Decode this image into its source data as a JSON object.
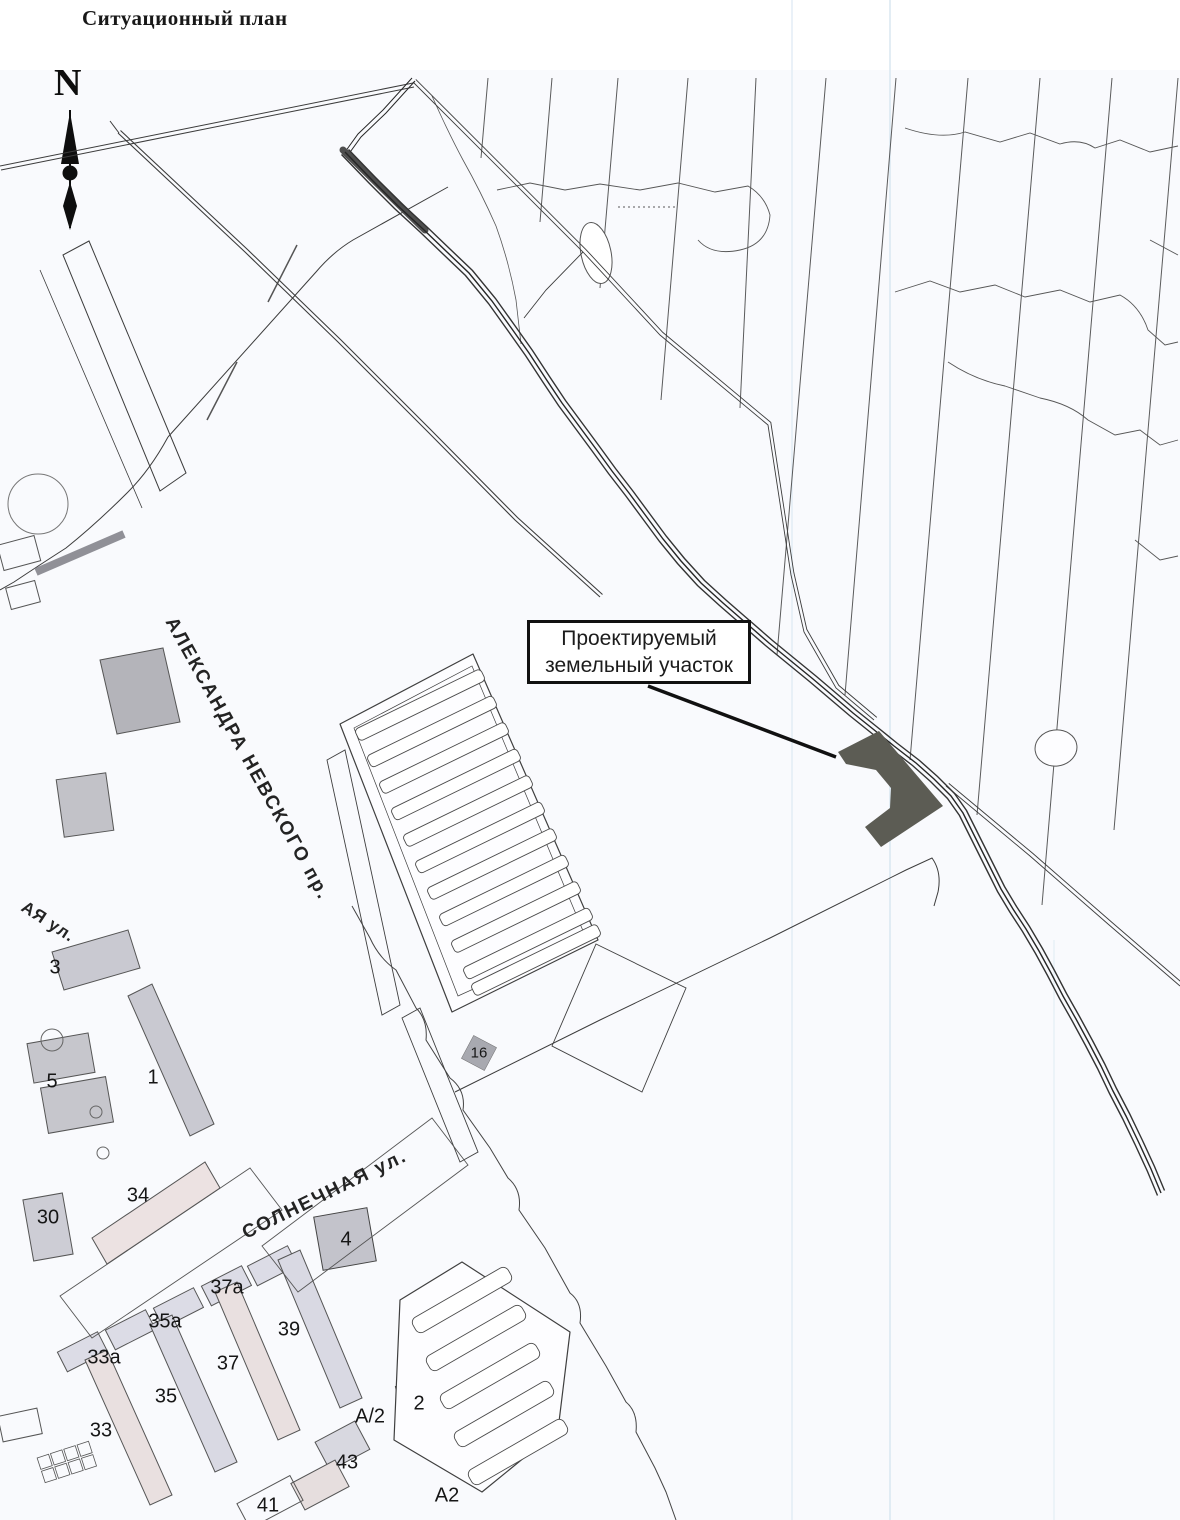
{
  "page_title": "Ситуационный план",
  "compass": {
    "north": "N"
  },
  "callout": {
    "line1": "Проектируемый",
    "line2": "земельный участок"
  },
  "streets": {
    "nevsky": {
      "label": "АЛЕКСАНДРА НЕВСКОГО пр."
    },
    "solnechnaya": {
      "label": "СОЛНЕЧНАЯ ул."
    },
    "partial_west": {
      "label": "АЯ ул."
    }
  },
  "map_labels": [
    {
      "text": "3",
      "x": 55,
      "y": 968
    },
    {
      "text": "5",
      "x": 52,
      "y": 1082
    },
    {
      "text": "1",
      "x": 153,
      "y": 1078
    },
    {
      "text": "34",
      "x": 138,
      "y": 1196
    },
    {
      "text": "30",
      "x": 48,
      "y": 1218
    },
    {
      "text": "4",
      "x": 346,
      "y": 1240
    },
    {
      "text": "16",
      "x": 479,
      "y": 1053,
      "size": 15
    },
    {
      "text": "33а",
      "x": 104,
      "y": 1358
    },
    {
      "text": "35а",
      "x": 165,
      "y": 1322
    },
    {
      "text": "37а",
      "x": 227,
      "y": 1288
    },
    {
      "text": "39",
      "x": 289,
      "y": 1330
    },
    {
      "text": "37",
      "x": 228,
      "y": 1364
    },
    {
      "text": "35",
      "x": 166,
      "y": 1397
    },
    {
      "text": "33",
      "x": 101,
      "y": 1431
    },
    {
      "text": "43",
      "x": 347,
      "y": 1463
    },
    {
      "text": "41",
      "x": 268,
      "y": 1506
    },
    {
      "text": "А/2",
      "x": 370,
      "y": 1417
    },
    {
      "text": "2",
      "x": 419,
      "y": 1404
    },
    {
      "text": "А2",
      "x": 447,
      "y": 1496
    }
  ],
  "colors": {
    "plot_fill": "#5c5c54",
    "road_stripe": "#a9a9b1",
    "paper": "#fcfdfe",
    "ink": "#3c3c3c",
    "fold_line": "#d7e5f0"
  }
}
